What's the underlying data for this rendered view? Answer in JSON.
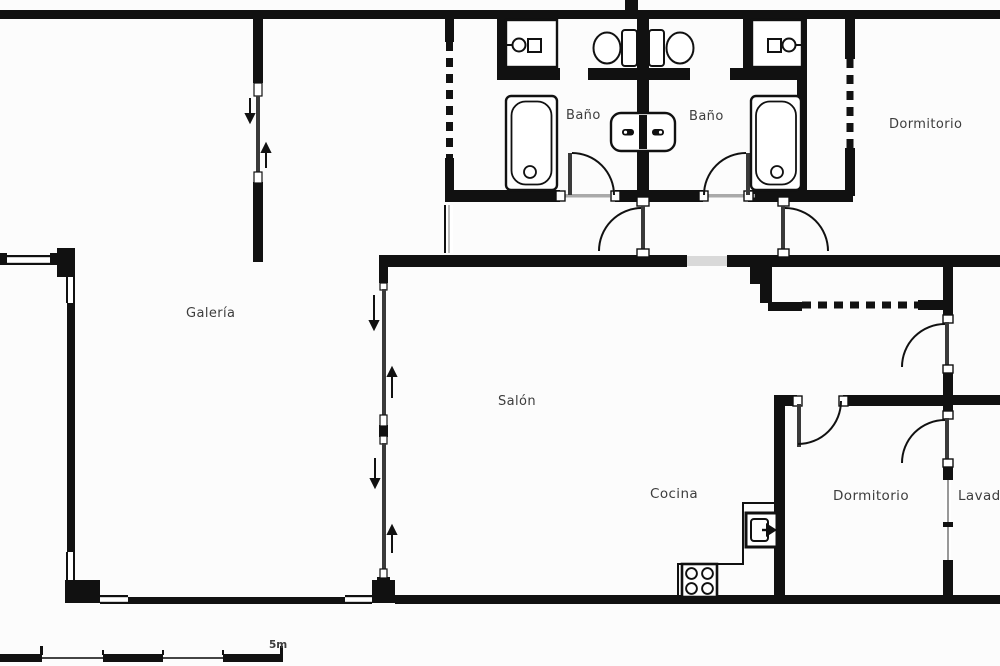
{
  "title": "Apartment floor plan",
  "rooms": {
    "galeria": "Galería",
    "bano_left": "Baño",
    "bano_right": "Baño",
    "dormitorio_top": "Dormitorio",
    "salon": "Salón",
    "cocina": "Cocina",
    "dormitorio_bottom": "Dormitorio",
    "lavadero": "Lavadero"
  },
  "scale_bar": {
    "label": "5m"
  },
  "fixtures": [
    "bathtub",
    "sink",
    "toilet",
    "bidet",
    "stove",
    "oven",
    "wardrobe-dashed",
    "sliding-door",
    "door-swing",
    "window"
  ],
  "colors": {
    "wall": "#111111",
    "background": "#fcfcfc",
    "window_glass": "#d9d9d9",
    "door_leaf": "#3a3a3a",
    "text": "#3d3d3d"
  }
}
